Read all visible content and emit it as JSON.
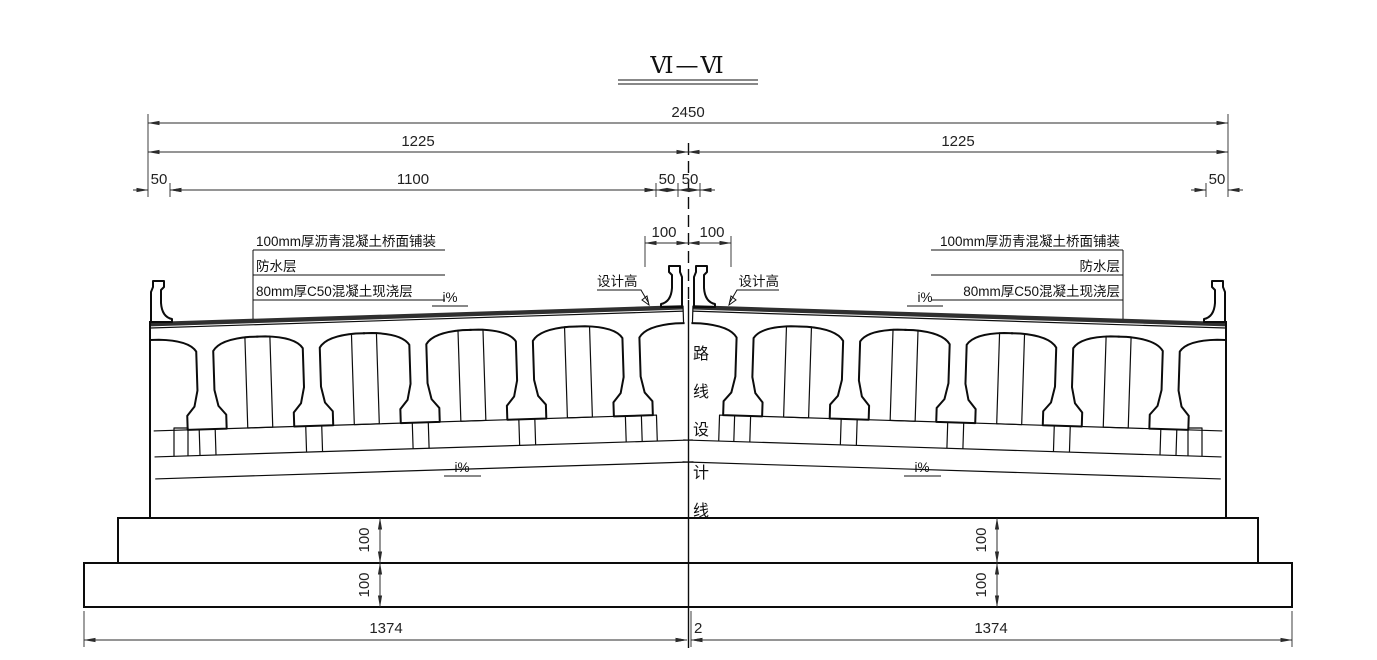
{
  "title": {
    "text": "Ⅵ—Ⅵ"
  },
  "dims": {
    "total": "2450",
    "half_left": "1225",
    "half_right": "1225",
    "edge_left": "50",
    "roadway": "1100",
    "median_left": "50",
    "median_right": "50",
    "edge_right": "50",
    "center_left": "100",
    "center_right": "100",
    "step_upper_left": "100",
    "step_lower_left": "100",
    "step_upper_right": "100",
    "step_lower_right": "100",
    "footing_left": "1374",
    "footing_center": "2",
    "footing_right": "1374"
  },
  "ann_left": {
    "pavement": "100mm厚沥青混凝土桥面铺装",
    "waterproof": "防水层",
    "cast_layer": "80mm厚C50混凝土现浇层",
    "design_height": "设计高",
    "slope_deck": "i%",
    "slope_cap": "i%"
  },
  "ann_right": {
    "pavement": "100mm厚沥青混凝土桥面铺装",
    "waterproof": "防水层",
    "cast_layer": "80mm厚C50混凝土现浇层",
    "design_height": "设计高",
    "slope_deck": "i%",
    "slope_cap": "i%"
  },
  "centerline": {
    "chars": [
      "路",
      "线",
      "设",
      "计",
      "线"
    ]
  },
  "colors": {
    "line": "#111111",
    "dim": "#2b2b2b"
  }
}
